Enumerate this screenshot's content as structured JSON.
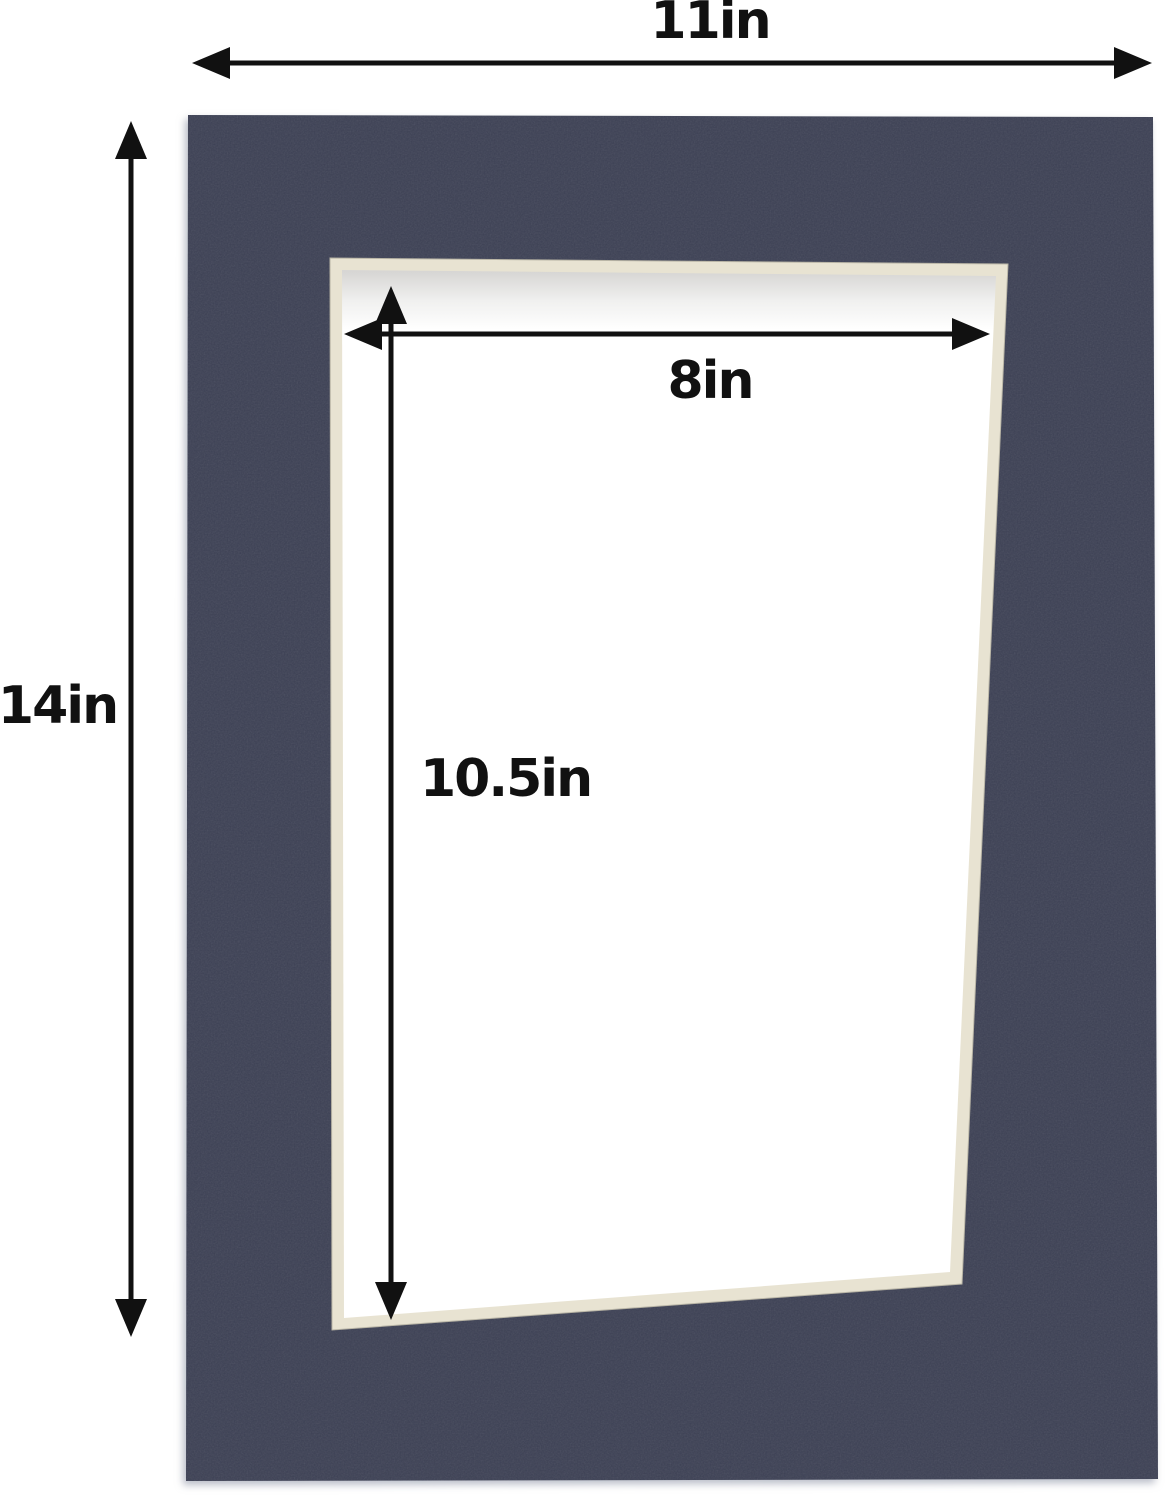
{
  "product_diagram": {
    "description": "Navy blue picture frame mat board with dimension annotations",
    "labels": {
      "outer_width": "11in",
      "outer_height": "14in",
      "opening_width": "8in",
      "opening_height": "10.5in"
    },
    "colors": {
      "mat": "#3c4054",
      "bevel": "#e8e3d2",
      "interior": "#ffffff",
      "annotation": "#111111",
      "background": "#ffffff"
    }
  }
}
